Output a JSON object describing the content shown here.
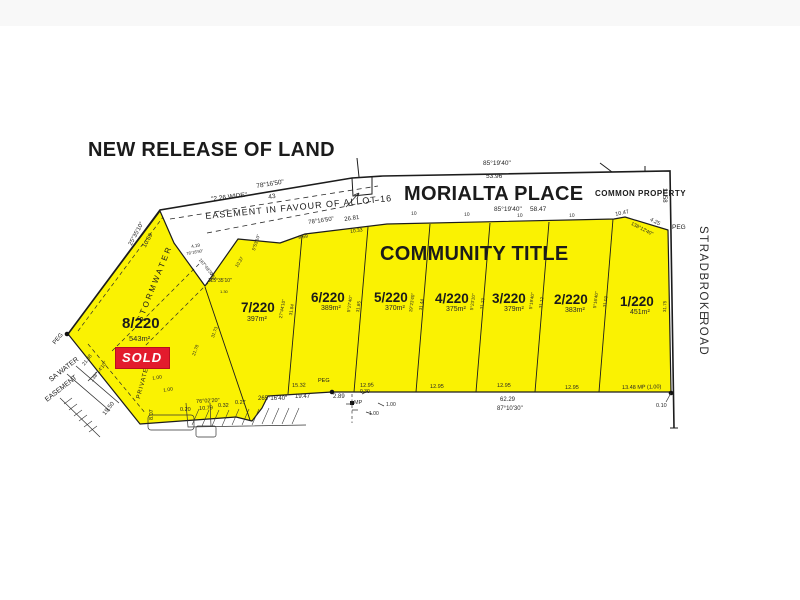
{
  "title": "NEW RELEASE OF LAND",
  "street": {
    "name": "MORIALTA PLACE",
    "common_property": "COMMON PROPERTY"
  },
  "road": {
    "line1": "STRADBROKE",
    "line2": "ROAD"
  },
  "community": "COMMUNITY TITLE",
  "easement": {
    "label": "EASEMENT  IN  FAVOUR  OF  ALLOT  16",
    "width": "\"2.26  WIDE\""
  },
  "annotations": {
    "stormwater": "STORMWATER",
    "private": "PRIVATE",
    "sa_water_1": "SA WATER",
    "sa_water_2": "EASEMENT",
    "sold": "SOLD",
    "peg_left": "PEG",
    "peg_bottom": "PEG",
    "peg_top_right": "PEG"
  },
  "lots": [
    {
      "id": "1/220",
      "area": "451m²"
    },
    {
      "id": "2/220",
      "area": "383m²"
    },
    {
      "id": "3/220",
      "area": "379m²"
    },
    {
      "id": "4/220",
      "area": "375m²"
    },
    {
      "id": "5/220",
      "area": "370m²"
    },
    {
      "id": "6/220",
      "area": "389m²"
    },
    {
      "id": "7/220",
      "area": "397m²"
    },
    {
      "id": "8/220",
      "area": "543m²",
      "status": "SOLD"
    }
  ],
  "dims": {
    "top_bearing": "85°19'40\"",
    "top_length": "53.96",
    "road_bearing": "85°19'40\"",
    "road_length": "58.47",
    "nw_bearing": "78°16'50\"",
    "nw_length": "43",
    "west_bearing": "25°35'10\"",
    "west_length": "10.69",
    "e_bearing": "78°16'50\"",
    "e_length": "26.81",
    "e_seg1": "9.69",
    "e_seg2": "10.33",
    "right_offset": "11.58",
    "chamfer_len": "10.47",
    "chamfer_bearing": "138°12'40\"",
    "chamfer_len2": "4.25",
    "notch_b1": "115°35'10\"",
    "notch_b2": "167°49'30\"",
    "notch_l1": "10.37",
    "notch_l2": "4.19",
    "notch_b3": "78°16'50\"",
    "notch_l3": "7.63",
    "notch_l4": "1.30",
    "lot7_bearing": "5°53'10\"",
    "bottom_bearing_w": "265°16'40\"",
    "bottom_w1": "19.47",
    "bottom_w2": "2.89",
    "bottom_w3": "15.32",
    "w1295a": "12.95",
    "w1295b": "12.95",
    "w1295c": "12.95",
    "w1295d": "12.95",
    "bottom_e": "13.48  MP (1.00)",
    "bottom_e2": "0.10",
    "bottom_total": "62.29",
    "bottom_bearing_e": "87°10'30\"",
    "sw_bearing": "76°02'20\"",
    "sw_l1": "10.79",
    "sw_l2": "0.32",
    "sw_l3": "0.27",
    "sw_l4": "0.20",
    "sw_l5": "8.07",
    "sw_l6": "19.50",
    "lot8_bearing": "138°14'10\"",
    "lot8_len": "21.38",
    "mp": "MP",
    "mp1": "0.30",
    "mp2": "1.00",
    "mp3": "1.00",
    "off1": "1.00",
    "off2": "1.00",
    "w10a": "10",
    "w10b": "10",
    "w10c": "10",
    "w10d": "10",
    "d87_1": "21.78",
    "d87_2": "31.73",
    "d76_1": "27°44'10\"",
    "d76_2": "31.84",
    "d65_1": "5°27'40\"",
    "d65_2": "31.85",
    "d54_1": "19°23'40\"",
    "d54_2": "31.44",
    "d43_1": "5°23'10\"",
    "d43_2": "31.23",
    "d32_1": "5°19'40\"",
    "d32_2": "31.12",
    "d21_1": "5°16'40\"",
    "d21_2": "31.03",
    "lot1_e": "31.75"
  }
}
